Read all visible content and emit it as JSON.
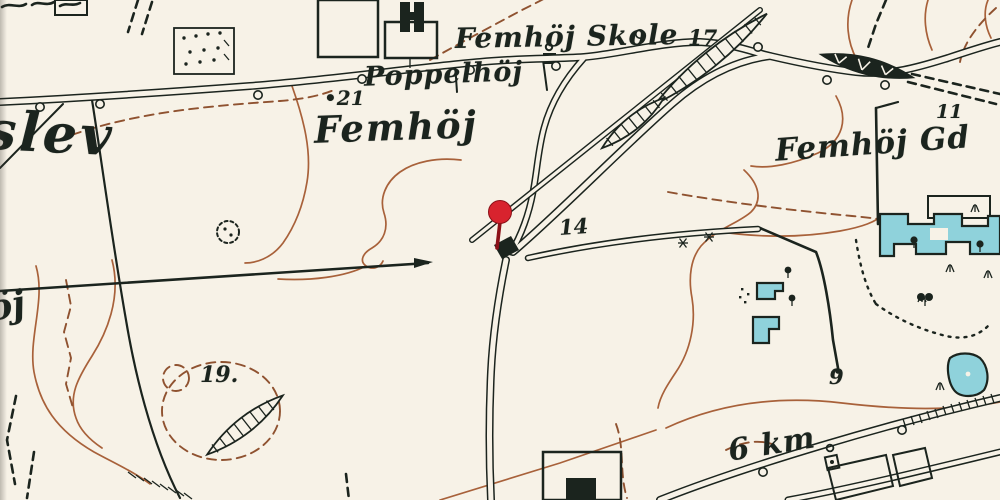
{
  "map": {
    "type": "historical-topographic-map",
    "labels": {
      "town_fragment": "slev",
      "hill_fragment": "öj",
      "school": "Femhöj Skole",
      "school_elevation": "17",
      "poppelhoj": "Poppelhöj",
      "spot_dot": "•",
      "spot_21": "21",
      "femhoj": "Femhöj",
      "femhoj_gd": "Femhöj Gd",
      "gd_elevation": "11",
      "road_number": "14",
      "spot_19": "19.",
      "boundary_9": "9",
      "distance": "6 km"
    },
    "marker": {
      "name": "station-pin",
      "meaning": "railway-halt-location"
    },
    "colors": {
      "paper": "#f7f2e7",
      "ink": "#1b241e",
      "contour": "#a8613a",
      "cyan": "#8fd2db",
      "pin": "#d8232e",
      "pin_dark": "#8c1118"
    }
  }
}
